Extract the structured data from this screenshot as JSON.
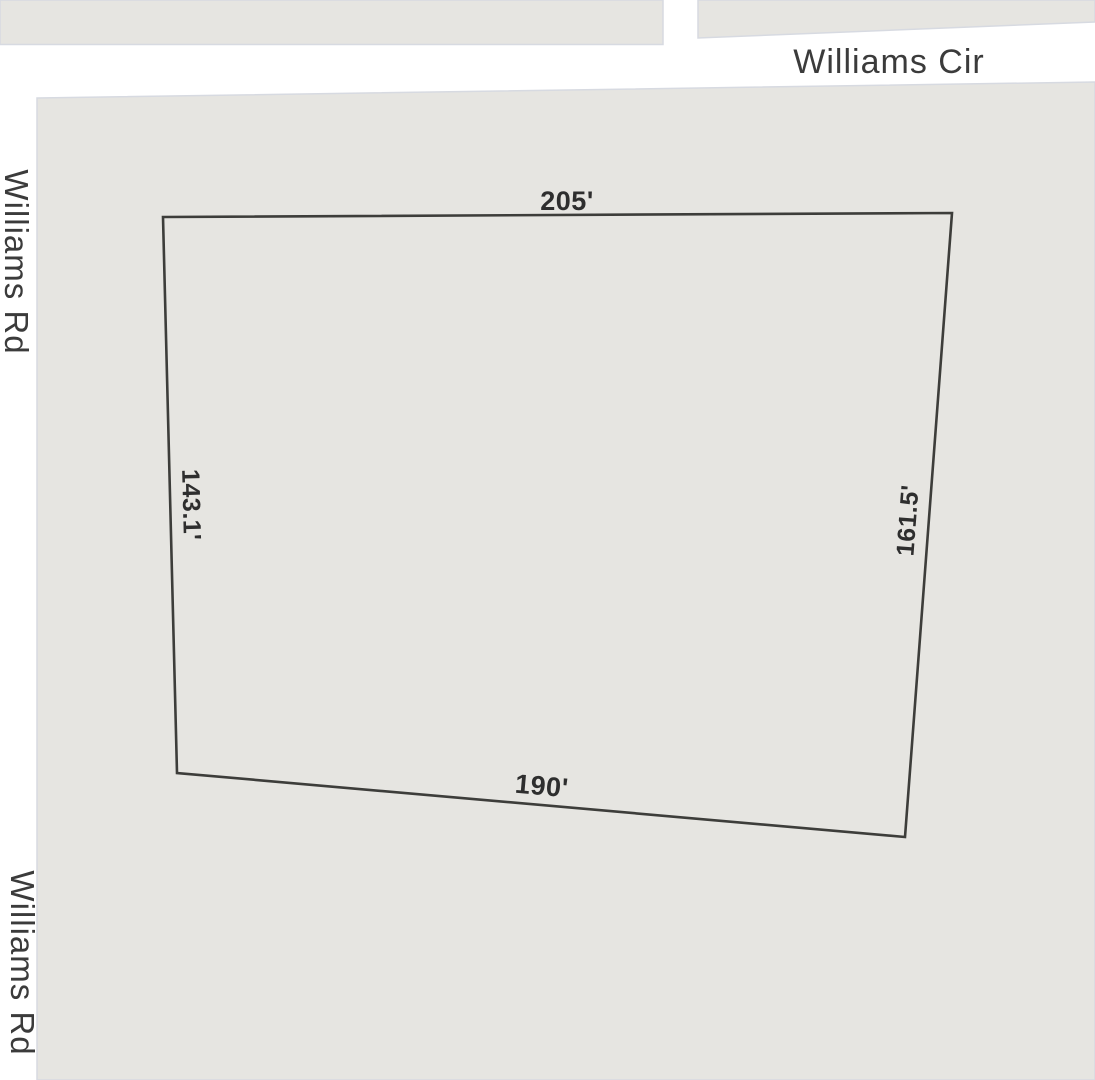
{
  "colors": {
    "road_fill": "#ffffff",
    "block_fill": "#e6e5e1",
    "block_border": "#d7dae1",
    "parcel_stroke": "#3d3d3a",
    "road_label": "#3b3b3b",
    "dimension_label": "#2e2e2e"
  },
  "roads": {
    "williams_cir": "Williams Cir",
    "williams_rd_top": "Williams Rd",
    "williams_rd_bottom": "Williams Rd"
  },
  "parcel": {
    "dim_top": "205'",
    "dim_left": "143.1'",
    "dim_right": "161.5'",
    "dim_bottom": "190'"
  }
}
